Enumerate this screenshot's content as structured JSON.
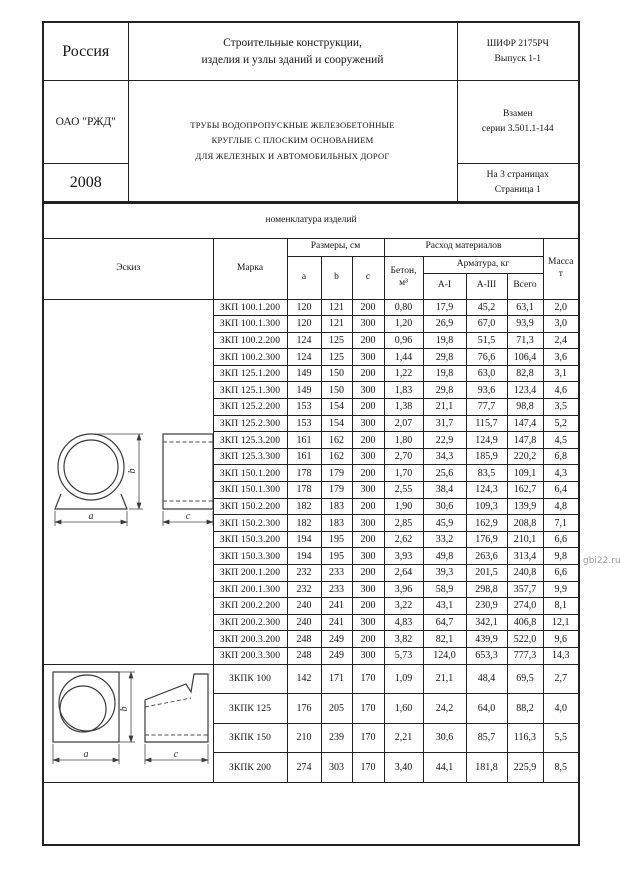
{
  "header": {
    "country": "Россия",
    "title_line1": "Строительные конструкции,",
    "title_line2": "изделия и узлы зданий и сооружений",
    "code_line1": "ШИФР 2175РЧ",
    "code_line2": "Выпуск 1-1",
    "org": "ОАО \"РЖД\"",
    "subject_line1": "ТРУБЫ ВОДОПРОПУСКНЫЕ ЖЕЛЕЗОБЕТОННЫЕ",
    "subject_line2": "КРУГЛЫЕ С ПЛОСКИМ ОСНОВАНИЕМ",
    "subject_line3": "ДЛЯ ЖЕЛЕЗНЫХ И АВТОМОБИЛЬНЫХ ДОРОГ",
    "replaces_line1": "Взамен",
    "replaces_line2": "серии 3.501.1-144",
    "year": "2008",
    "pages_line1": "На 3 страницах",
    "pages_line2": "Страница 1"
  },
  "section_title": "номенклатура изделий",
  "table": {
    "col_sketch": "Эскиз",
    "col_mark": "Марка",
    "col_sizes": "Размеры, см",
    "col_a": "a",
    "col_b": "b",
    "col_c": "c",
    "col_materials": "Расход материалов",
    "col_concrete_l1": "Бетон,",
    "col_concrete_l2": "м³",
    "col_rebar": "Арматура, кг",
    "col_ai": "А-I",
    "col_aiii": "А-III",
    "col_total": "Всего",
    "col_mass_l1": "Масса",
    "col_mass_l2": "т",
    "rows_zkp": [
      [
        "ЗКП 100.1.200",
        "120",
        "121",
        "200",
        "0,80",
        "17,9",
        "45,2",
        "63,1",
        "2,0"
      ],
      [
        "ЗКП 100.1.300",
        "120",
        "121",
        "300",
        "1,20",
        "26,9",
        "67,0",
        "93,9",
        "3,0"
      ],
      [
        "ЗКП 100.2.200",
        "124",
        "125",
        "200",
        "0,96",
        "19,8",
        "51,5",
        "71,3",
        "2,4"
      ],
      [
        "ЗКП 100.2.300",
        "124",
        "125",
        "300",
        "1,44",
        "29,8",
        "76,6",
        "106,4",
        "3,6"
      ],
      [
        "ЗКП 125.1.200",
        "149",
        "150",
        "200",
        "1,22",
        "19,8",
        "63,0",
        "82,8",
        "3,1"
      ],
      [
        "ЗКП 125.1.300",
        "149",
        "150",
        "300",
        "1,83",
        "29,8",
        "93,6",
        "123,4",
        "4,6"
      ],
      [
        "ЗКП 125.2.200",
        "153",
        "154",
        "200",
        "1,38",
        "21,1",
        "77,7",
        "98,8",
        "3,5"
      ],
      [
        "ЗКП 125.2.300",
        "153",
        "154",
        "300",
        "2,07",
        "31,7",
        "115,7",
        "147,4",
        "5,2"
      ],
      [
        "ЗКП 125.3.200",
        "161",
        "162",
        "200",
        "1,80",
        "22,9",
        "124,9",
        "147,8",
        "4,5"
      ],
      [
        "ЗКП 125.3.300",
        "161",
        "162",
        "300",
        "2,70",
        "34,3",
        "185,9",
        "220,2",
        "6,8"
      ],
      [
        "ЗКП 150.1.200",
        "178",
        "179",
        "200",
        "1,70",
        "25,6",
        "83,5",
        "109,1",
        "4,3"
      ],
      [
        "ЗКП 150.1.300",
        "178",
        "179",
        "300",
        "2,55",
        "38,4",
        "124,3",
        "162,7",
        "6,4"
      ],
      [
        "ЗКП 150.2.200",
        "182",
        "183",
        "200",
        "1,90",
        "30,6",
        "109,3",
        "139,9",
        "4,8"
      ],
      [
        "ЗКП 150.2.300",
        "182",
        "183",
        "300",
        "2,85",
        "45,9",
        "162,9",
        "208,8",
        "7,1"
      ],
      [
        "ЗКП 150.3.200",
        "194",
        "195",
        "200",
        "2,62",
        "33,2",
        "176,9",
        "210,1",
        "6,6"
      ],
      [
        "ЗКП 150.3.300",
        "194",
        "195",
        "300",
        "3,93",
        "49,8",
        "263,6",
        "313,4",
        "9,8"
      ],
      [
        "ЗКП 200.1.200",
        "232",
        "233",
        "200",
        "2,64",
        "39,3",
        "201,5",
        "240,8",
        "6,6"
      ],
      [
        "ЗКП 200.1.300",
        "232",
        "233",
        "300",
        "3,96",
        "58,9",
        "298,8",
        "357,7",
        "9,9"
      ],
      [
        "ЗКП 200.2.200",
        "240",
        "241",
        "200",
        "3,22",
        "43,1",
        "230,9",
        "274,0",
        "8,1"
      ],
      [
        "ЗКП 200.2.300",
        "240",
        "241",
        "300",
        "4,83",
        "64,7",
        "342,1",
        "406,8",
        "12,1"
      ],
      [
        "ЗКП 200.3.200",
        "248",
        "249",
        "200",
        "3,82",
        "82,1",
        "439,9",
        "522,0",
        "9,6"
      ],
      [
        "ЗКП 200.3.300",
        "248",
        "249",
        "300",
        "5,73",
        "124,0",
        "653,3",
        "777,3",
        "14,3"
      ]
    ],
    "rows_zkpk": [
      [
        "ЗКПК 100",
        "142",
        "171",
        "170",
        "1,09",
        "21,1",
        "48,4",
        "69,5",
        "2,7"
      ],
      [
        "ЗКПК 125",
        "176",
        "205",
        "170",
        "1,60",
        "24,2",
        "64,0",
        "88,2",
        "4,0"
      ],
      [
        "ЗКПК 150",
        "210",
        "239",
        "170",
        "2,21",
        "30,6",
        "85,7",
        "116,3",
        "5,5"
      ],
      [
        "ЗКПК 200",
        "274",
        "303",
        "170",
        "3,40",
        "44,1",
        "181,8",
        "225,9",
        "8,5"
      ]
    ]
  },
  "sketches": {
    "dim_a": "a",
    "dim_b": "b",
    "dim_c": "c"
  },
  "watermark": "gbi22.ru",
  "colors": {
    "border": "#222222",
    "text": "#151515",
    "watermark": "#9a9a9a",
    "paper": "#ffffff"
  }
}
